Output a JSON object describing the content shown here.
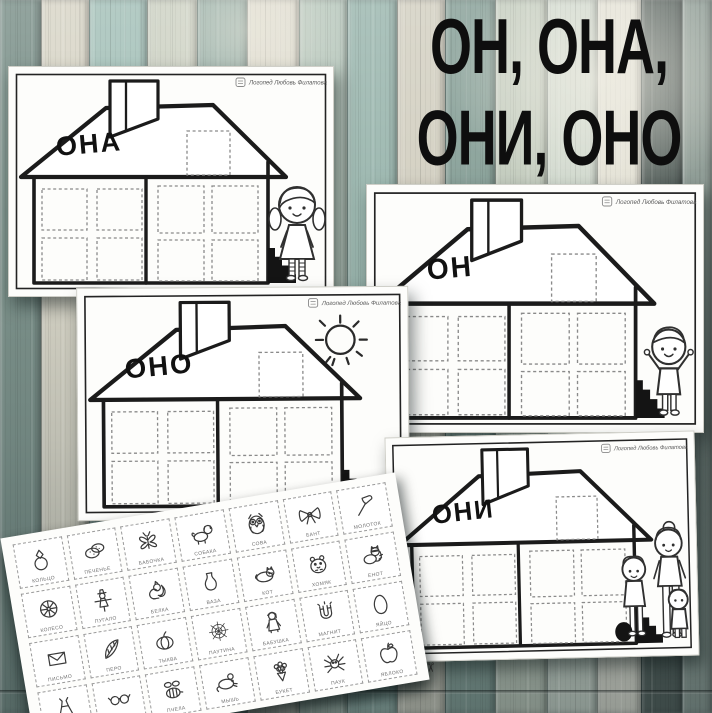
{
  "title": {
    "line1": "ОН, ОНА,",
    "line2": "ОНИ, ОНО"
  },
  "branding": {
    "logo_text": "Логопед Любовь Филатова"
  },
  "worksheets": [
    {
      "id": "ona",
      "roof_label": "ОНА",
      "character": "girl",
      "character_name": "girl-with-pigtails"
    },
    {
      "id": "on",
      "roof_label": "ОН",
      "character": "boy",
      "character_name": "boy-arms-raised"
    },
    {
      "id": "ono",
      "roof_label": "ОНО",
      "character": "sun",
      "character_name": "sun-drawing"
    },
    {
      "id": "oni",
      "roof_label": "ОНИ",
      "character": "family",
      "character_name": "mother-with-children"
    }
  ],
  "cards": {
    "scissors_icon": "✂",
    "rows": [
      [
        {
          "label": "КОЛЬЦО",
          "icon": "ring-icon"
        },
        {
          "label": "ПЕЧЕНЬЕ",
          "icon": "cookies-icon"
        },
        {
          "label": "БАБОЧКА",
          "icon": "butterfly-icon"
        },
        {
          "label": "СОБАКА",
          "icon": "dog-icon"
        },
        {
          "label": "СОВА",
          "icon": "owl-icon"
        },
        {
          "label": "БАНТ",
          "icon": "bow-icon"
        },
        {
          "label": "МОЛОТОК",
          "icon": "hammer-icon"
        }
      ],
      [
        {
          "label": "КОЛЕСО",
          "icon": "wheel-icon"
        },
        {
          "label": "ПУГАЛО",
          "icon": "scarecrow-icon"
        },
        {
          "label": "БЕЛКА",
          "icon": "squirrel-icon"
        },
        {
          "label": "ВАЗА",
          "icon": "vase-icon"
        },
        {
          "label": "КОТ",
          "icon": "cat-icon"
        },
        {
          "label": "ХОМЯК",
          "icon": "hamster-icon"
        },
        {
          "label": "ЕНОТ",
          "icon": "raccoon-icon"
        }
      ],
      [
        {
          "label": "ПИСЬМО",
          "icon": "envelope-icon"
        },
        {
          "label": "ПЕРО",
          "icon": "feather-icon"
        },
        {
          "label": "ТЫКВА",
          "icon": "pumpkin-icon"
        },
        {
          "label": "ПАУТИНА",
          "icon": "spiderweb-icon"
        },
        {
          "label": "БАБУШКА",
          "icon": "grandma-icon"
        },
        {
          "label": "МАГНИТ",
          "icon": "magnet-icon"
        },
        {
          "label": "ЯЙЦО",
          "icon": "egg-icon"
        }
      ],
      [
        {
          "label": "ПЛАТЬЕ",
          "icon": "dress-icon"
        },
        {
          "label": "ОЧКИ",
          "icon": "glasses-icon"
        },
        {
          "label": "ПЧЕЛА",
          "icon": "bee-icon"
        },
        {
          "label": "МЫШЬ",
          "icon": "mouse-icon"
        },
        {
          "label": "БУКЕТ",
          "icon": "bouquet-icon"
        },
        {
          "label": "ПАУК",
          "icon": "spider-icon"
        },
        {
          "label": "ЯБЛОКО",
          "icon": "apple-icon"
        }
      ]
    ]
  },
  "colors": {
    "title_text": "#0e0e0e",
    "paper": "#fdfdfb",
    "ink": "#1b1b1b",
    "stairs": "#141414",
    "planks": [
      "#7e938c",
      "#d9d6c8",
      "#a6c2ba",
      "#ccd1c3",
      "#93aca4",
      "#e0ddd0",
      "#b5c6bb",
      "#9db8b0",
      "#d4d1c3",
      "#8aa29a",
      "#c3ccbe",
      "#cfd8cd",
      "#e4e2d6",
      "#55605c",
      "#8e9c95"
    ]
  }
}
